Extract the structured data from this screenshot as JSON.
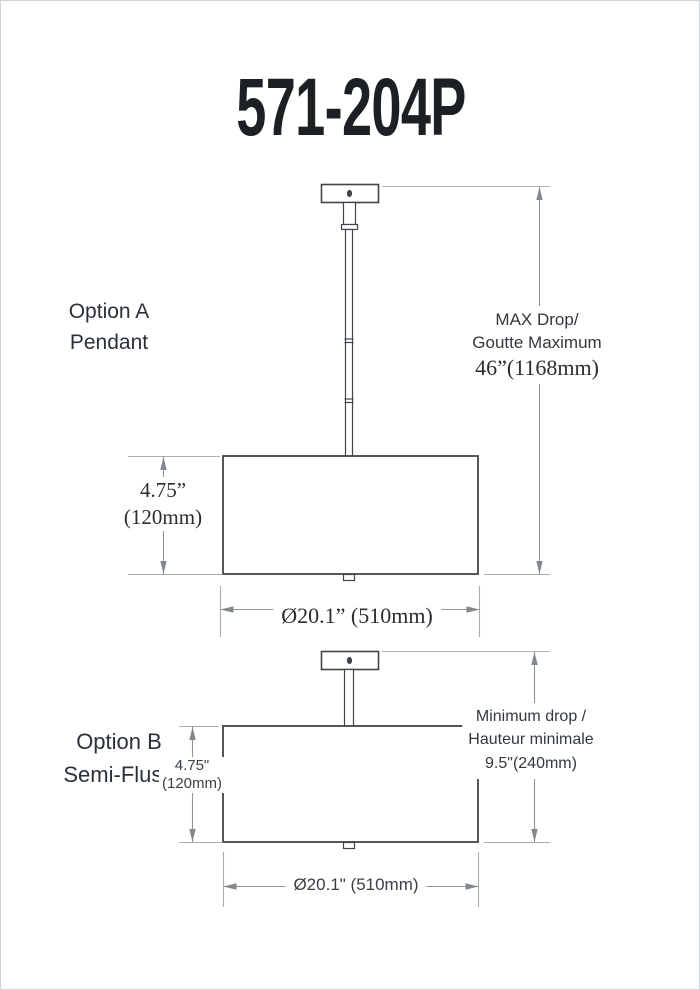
{
  "title": "571-204P",
  "colors": {
    "fixture_line": "#3f454a",
    "dimension_line": "#8f959a",
    "extension_line": "#b2b6ba",
    "arrow": "#83888c",
    "text": "#23282c"
  },
  "option_a": {
    "label": [
      "Option A",
      "Pendant"
    ],
    "shade_height": [
      "4.75”",
      "(120mm)"
    ],
    "diameter": "Ø20.1” (510mm)",
    "max_drop": [
      "MAX Drop/",
      "Goutte Maximum",
      "46”(1168mm)"
    ]
  },
  "option_b": {
    "label": [
      "Option B",
      "Semi-Flush"
    ],
    "shade_height": [
      "4.75\"",
      "(120mm)"
    ],
    "diameter": "Ø20.1\" (510mm)",
    "min_drop": [
      "Minimum drop /",
      "Hauteur minimale",
      "9.5\"(240mm)"
    ]
  }
}
